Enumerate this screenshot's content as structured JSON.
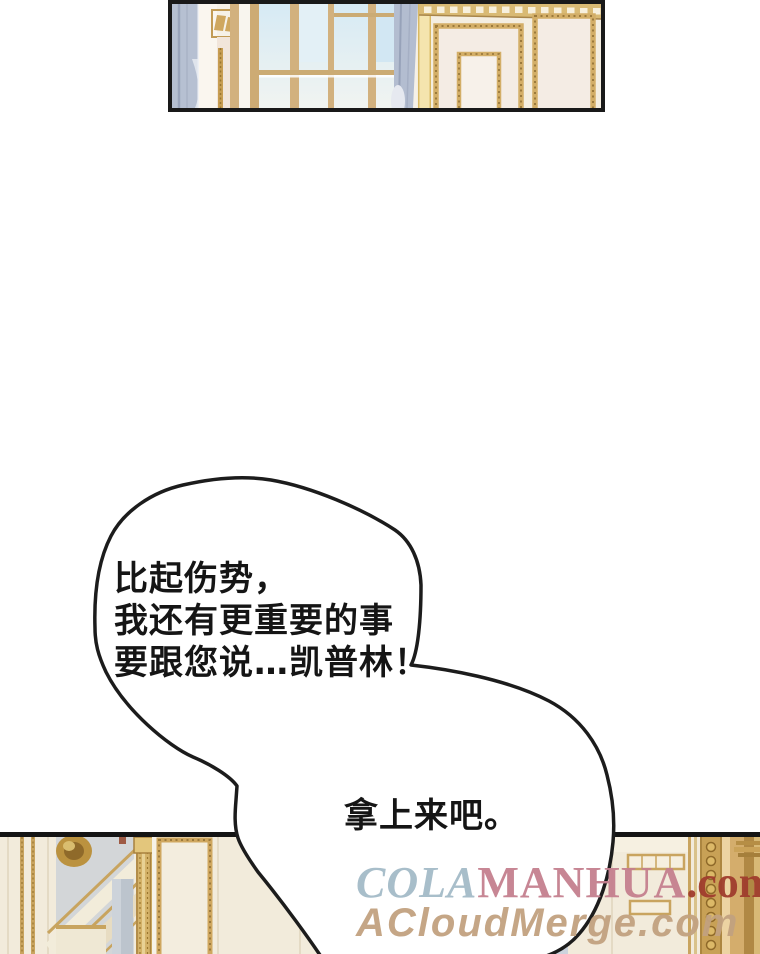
{
  "speech_bubble": {
    "lines": [
      "比起伤势，",
      "我还有更重要的事",
      "要跟您说…凯普林！"
    ],
    "reply": "拿上来吧。"
  },
  "watermark": {
    "site1_cola": "COLA",
    "site1_manhua": "MANHUA",
    "site1_com": ".com",
    "site2": "ACloudMerge.com"
  },
  "colors": {
    "panel_border": "#191919",
    "bubble_outline": "#1c1c1c",
    "speech_text": "#151515",
    "watermark_cola": "#a4bbc8",
    "watermark_manhua": "#c5808f",
    "watermark_com": "#a03d2d",
    "watermark_site2": "#c2a280",
    "wall_cream": "#f4eee1",
    "gold_trim": "#cfa75f",
    "curtain_blue": "#b3bdd0",
    "sky_blue": "#d6eaf4"
  }
}
